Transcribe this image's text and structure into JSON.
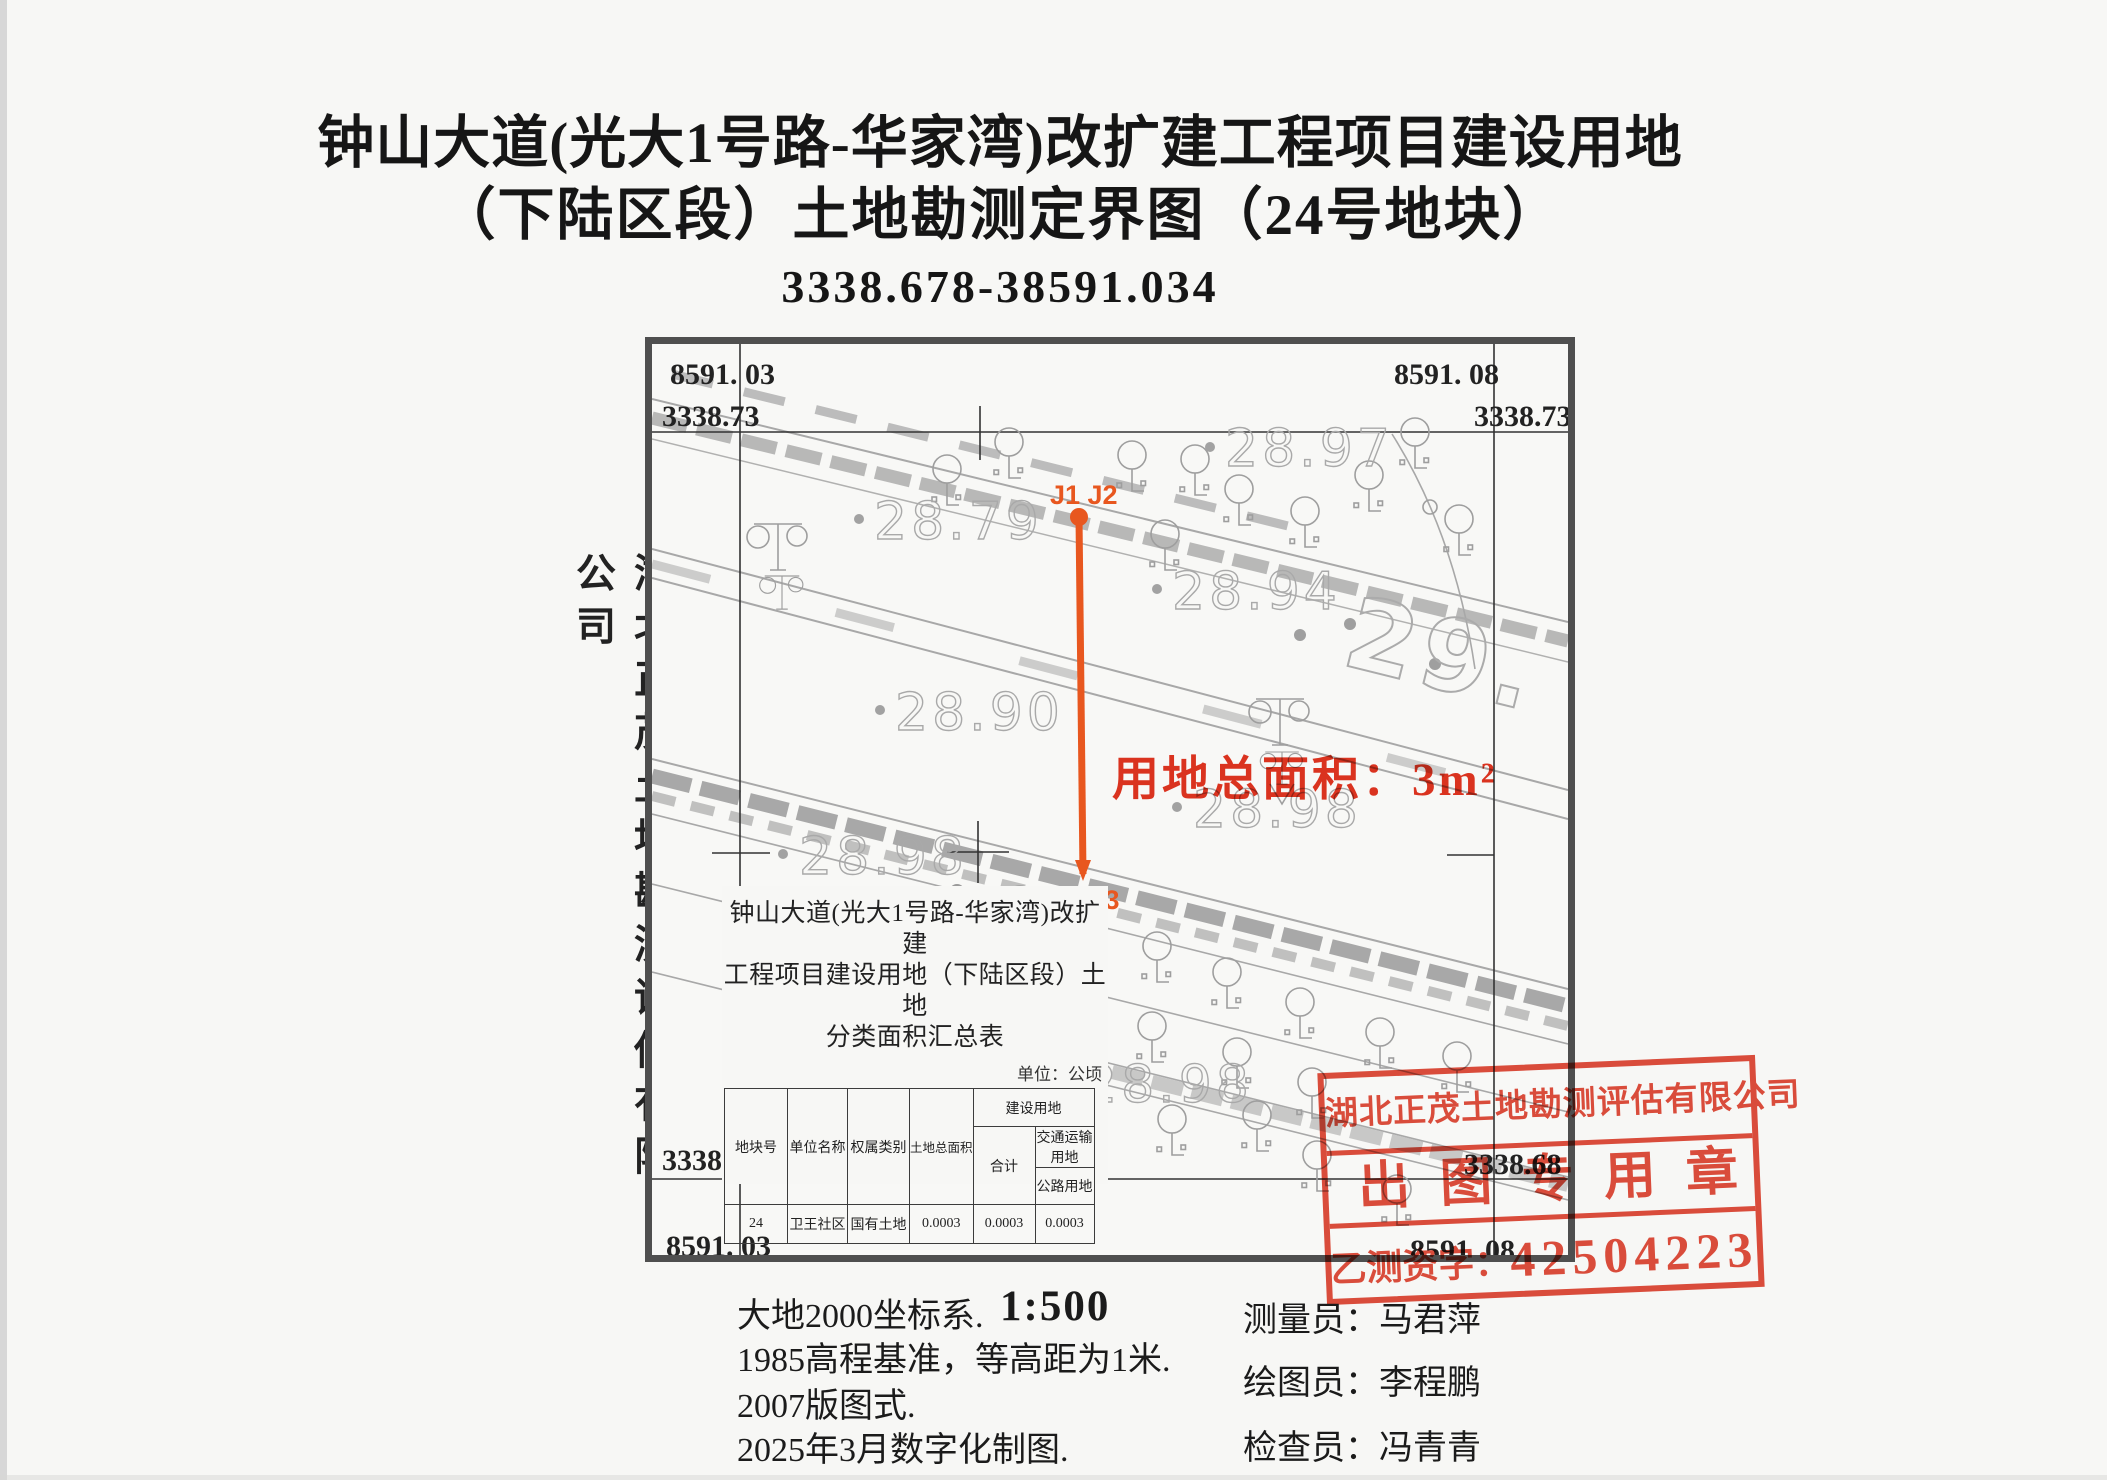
{
  "title": {
    "line1": "钟山大道(光大1号路-华家湾)改扩建工程项目建设用地",
    "line2": "（下陆区段）土地勘测定界图（24号地块）",
    "line3": "3338.678-38591.034"
  },
  "company_vertical": "湖北正茂土地勘测评估有限公司",
  "map": {
    "corners": {
      "tl_easting": "8591. 03",
      "tl_northing": "3338.73",
      "tr_easting": "8591. 08",
      "tr_northing": "3338.73",
      "bl_northing": "3338.6",
      "bl_easting": "8591. 03",
      "br_northing": "3338.68",
      "br_easting": "8591. 08"
    },
    "elevations": [
      "28.79",
      "28.97",
      "28.94",
      "28.90",
      "28.98",
      "28.98",
      "28.98"
    ],
    "big_contour_label": "29.",
    "boundary_labels": {
      "top": "J1 J2",
      "bottom": "J4 J3"
    },
    "area_note": "用地总面积：3m²"
  },
  "summary_table": {
    "title_line1": "钟山大道(光大1号路-华家湾)改扩建",
    "title_line2": "工程项目建设用地（下陆区段）土地",
    "title_line3": "分类面积汇总表",
    "unit_note": "单位：公顷",
    "headers": {
      "parcel": "地块号",
      "unit_name": "单位名称",
      "ownership": "权属类别",
      "total_area": "土地总面积",
      "construction": "建设用地",
      "subtotal": "合计",
      "transport": "交通运输用地",
      "road": "公路用地"
    },
    "row": {
      "parcel": "24",
      "unit_name": "卫王社区",
      "ownership": "国有土地",
      "total": "0.0003",
      "subtotal": "0.0003",
      "road": "0.0003"
    }
  },
  "stamp": {
    "company": "湖北正茂土地勘测评估有限公司",
    "title": "出图专用章",
    "cert_label": "乙测资字：",
    "cert_number": "42504223"
  },
  "footer": {
    "coord_system": "大地2000坐标系.",
    "scale": "1:500",
    "datum": "1985高程基准，等高距为1米.",
    "map_style": "2007版图式.",
    "produced": "2025年3月数字化制图.",
    "surveyor": "测量员：马君萍",
    "drafter": "绘图员：李程鹏",
    "checker": "检查员：冯青青"
  },
  "colors": {
    "stamp_red": "#dd3a27",
    "boundary_orange": "#e8571f",
    "area_note_red": "#e13420",
    "map_gray": "#a8a8a8"
  }
}
